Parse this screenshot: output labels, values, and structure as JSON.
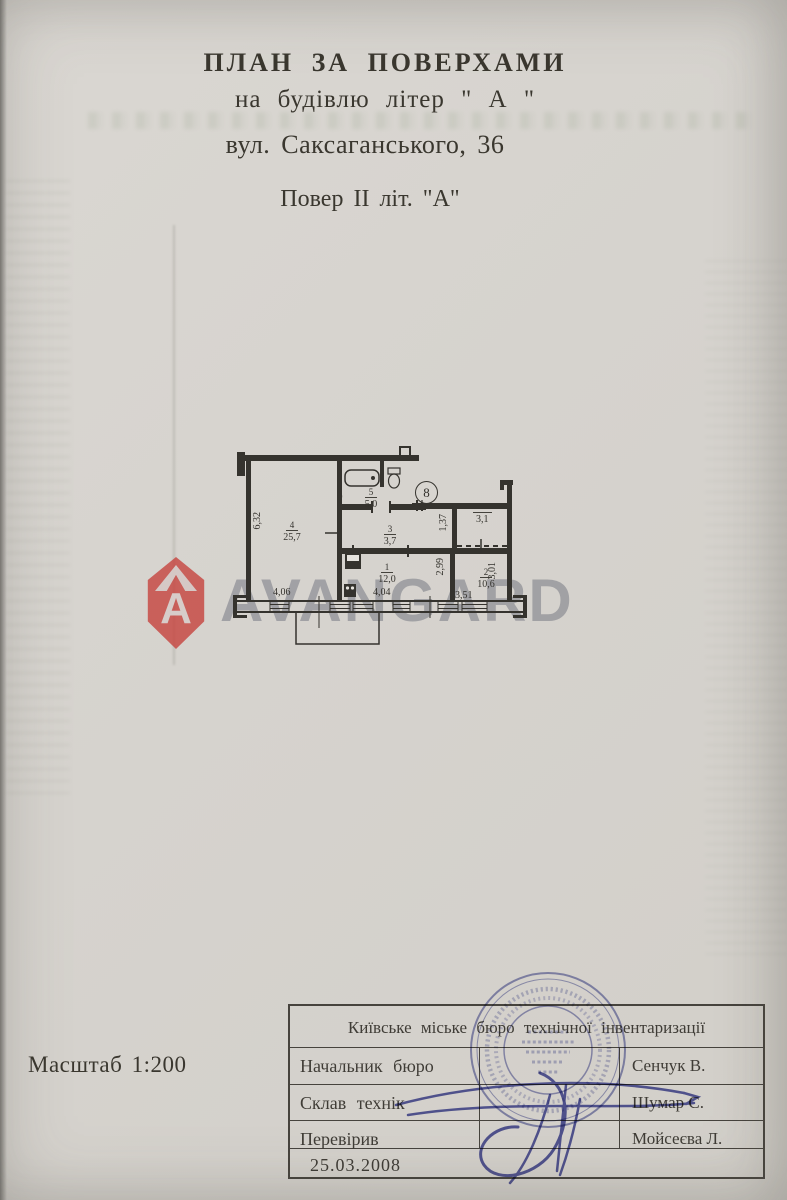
{
  "heading": {
    "line1": "ПЛАН ЗА ПОВЕРХАМИ",
    "line2": "на будівлю літер \" А \"",
    "line3": "вул. Саксаганського, 36",
    "line4": "Повер II літ. \"А\""
  },
  "scale_label": "Масштаб 1:200",
  "watermark": {
    "brand": "AVANGARD",
    "logo_letter": "A",
    "logo_color": "#c53f3a",
    "text_color": "#767983"
  },
  "plan": {
    "badge_number": "8",
    "rooms": [
      {
        "number": "4",
        "area": "25,7"
      },
      {
        "number": "5",
        "area": "5,0"
      },
      {
        "number": "3",
        "area": "3,7"
      },
      {
        "number": "1",
        "area": "12,0"
      },
      {
        "number": "2",
        "area": "10,6"
      }
    ],
    "closet_area": "3,1",
    "dimensions": {
      "left_wall": "6,32",
      "corridor": "1,37",
      "room1_depth": "2,99",
      "room2_depth": "3,01",
      "bottom": [
        "4,06",
        "4,04",
        "3,51"
      ]
    }
  },
  "table": {
    "header": "Київське міське бюро технічної інвентаризації",
    "rows": [
      {
        "label": "Начальник бюро",
        "name": "Сенчук В."
      },
      {
        "label": "Склав технік",
        "name": "Шумар С."
      },
      {
        "label": "Перевірив",
        "name": "Мойсеєва Л."
      }
    ],
    "date": "25.03.2008"
  },
  "stamp": {
    "ink_color": "#585da8"
  }
}
